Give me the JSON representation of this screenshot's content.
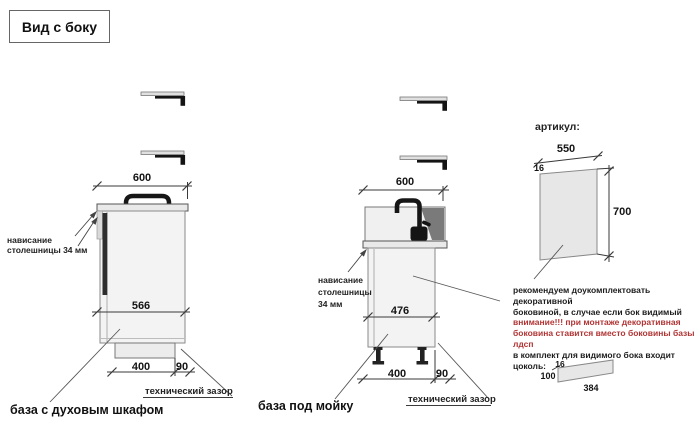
{
  "title": "Вид с боку",
  "colors": {
    "attention_red": "#b13434",
    "line": "#3a3a3a",
    "cabinet_fill": "#f3f3f3",
    "panel_fill": "#e7e7e7",
    "dark_part": "#1f1f1f"
  },
  "left_cabinet": {
    "label": "база с духовым шкафом",
    "overhang_lines": [
      "нависание",
      "столешницы 34 мм"
    ],
    "gap_label": "технический зазор",
    "dims": {
      "countertop_depth": "600",
      "body_depth": "566",
      "plinth_depth": "400",
      "rear_gap": "90"
    }
  },
  "sink_cabinet": {
    "label": "база под мойку",
    "overhang_lines": [
      "нависание",
      "столешницы",
      "34 мм"
    ],
    "gap_label": "технический зазор",
    "dims": {
      "countertop_depth": "600",
      "body_depth": "476",
      "plinth_depth": "400",
      "rear_gap": "90"
    }
  },
  "side_panel": {
    "heading": "артикул:",
    "dims": {
      "width": "550",
      "thickness": "16",
      "height": "700"
    },
    "note_lines": [
      "рекомендуем доукомплектовать декоративной",
      "боковиной, в случае если бок видимый",
      "внимание!!! при монтаже декоративная",
      "боковина ставится вместо боковины базы лдсп",
      "в комплект для видимого бока входит цоколь:"
    ]
  },
  "plinth_part": {
    "dims": {
      "thickness": "16",
      "height": "100",
      "length": "384"
    }
  }
}
